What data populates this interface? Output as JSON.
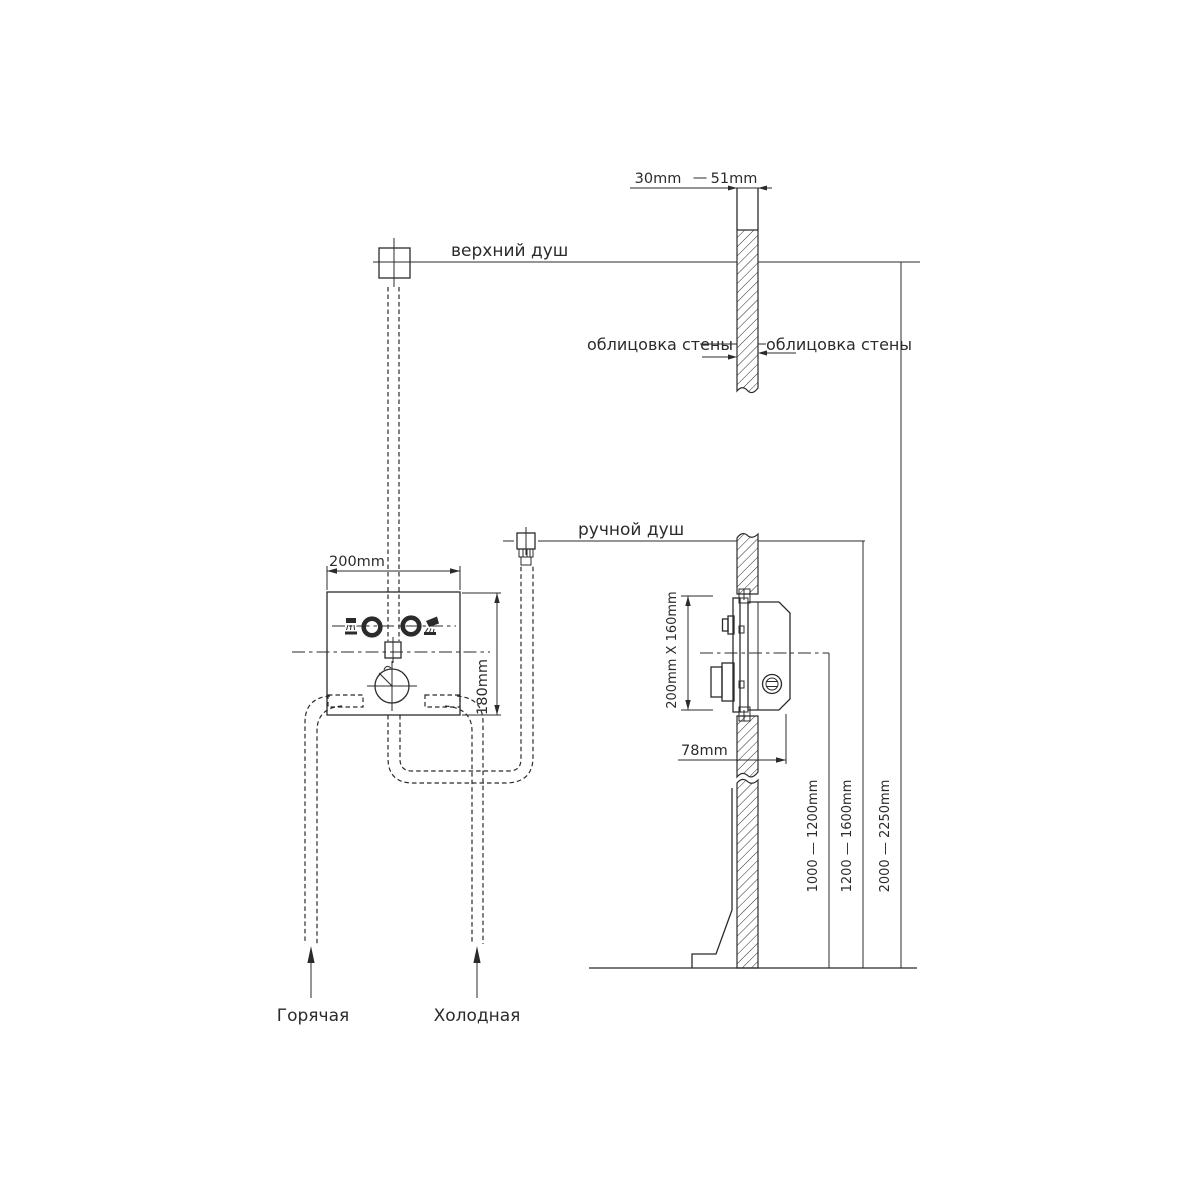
{
  "front_view": {
    "overhead_shower_label": "верхний душ",
    "hand_shower_label": "ручной душ",
    "box_width": "200mm",
    "box_height": "180mm",
    "hot_label": "Горячая",
    "cold_label": "Холодная"
  },
  "side_view": {
    "wall_thickness_min": "30mm",
    "wall_thickness_sep": "—",
    "wall_thickness_max": "51mm",
    "cladding_left": "облицовка стены",
    "cladding_right": "облицовка стены",
    "rough_in_size": "200mm X 160mm",
    "body_depth": "78mm",
    "mixer_height": "1000 — 1200mm",
    "hand_shower_height": "1200 — 1600mm",
    "overhead_shower_height": "2000 — 2250mm"
  },
  "colors": {
    "line": "#2b2b2b",
    "background": "#ffffff"
  }
}
